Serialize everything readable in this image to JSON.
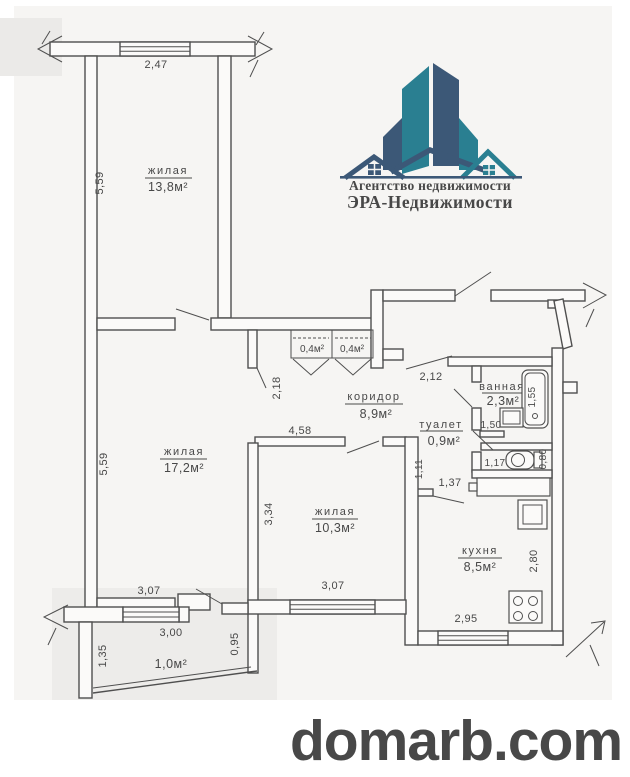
{
  "logo": {
    "agency_line1": "Агентство недвижимости",
    "agency_line2": "ЭРА-Недвижимости",
    "colors": {
      "teal": "#2A7F91",
      "navy": "#3C5877",
      "text_green": "#1E7A6A",
      "text_blue": "#3E6E9E"
    }
  },
  "watermark": {
    "text": "domarb.com",
    "color": "#8B0D0D"
  },
  "floorplan": {
    "line_color": "#4f4f4f",
    "rooms": {
      "living1": {
        "name": "жилая",
        "area": "13,8м²"
      },
      "living2": {
        "name": "жилая",
        "area": "17,2м²"
      },
      "living3": {
        "name": "жилая",
        "area": "10,3м²"
      },
      "corridor": {
        "name": "коридор",
        "area": "8,9м²"
      },
      "bathroom": {
        "name": "ванная",
        "area": "2,3м²"
      },
      "toilet": {
        "name": "туалет",
        "area": "0,9м²"
      },
      "kitchen": {
        "name": "кухня",
        "area": "8,5м²"
      },
      "closet1": {
        "area": "0,4м²"
      },
      "closet2": {
        "area": "0,4м²"
      },
      "balcony": {
        "area": "1,0м²"
      }
    },
    "dims": {
      "living1_width": "2,47",
      "living1_height": "5,59",
      "living2_height": "5,59",
      "living2_width": "3,07",
      "living3_height": "3,34",
      "living3_width": "3,07",
      "living3_top": "4,58",
      "corridor_opening": "2,18",
      "hall_entry": "2,12",
      "bath_length": "1,55",
      "bath_width": "1,50",
      "toilet_width": "1,17",
      "toilet_depth": "0,80",
      "hall_width": "1,11",
      "hall_length": "1,37",
      "kitchen_height": "2,80",
      "kitchen_width": "2,95",
      "balcony_width": "3,00",
      "balcony_left": "1,35",
      "balcony_right": "0,95"
    }
  }
}
